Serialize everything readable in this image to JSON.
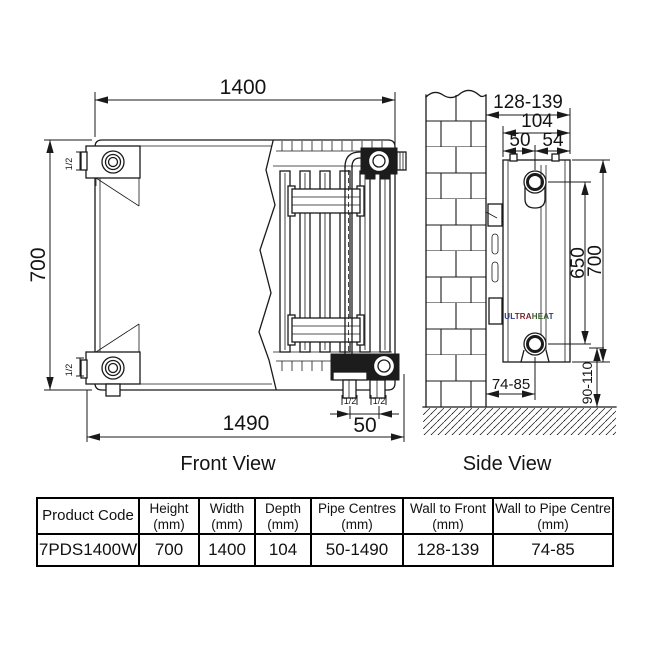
{
  "front_view": {
    "caption": "Front View",
    "dim_width": "1400",
    "dim_height": "700",
    "dim_overall_width": "1490",
    "dim_pipe_spacing": "50",
    "conn_top_left": "1/2",
    "conn_bottom_left": "1/2",
    "conn_bottom_right_1": "1/2",
    "conn_bottom_right_2": "1/2"
  },
  "side_view": {
    "caption": "Side View",
    "dim_wall_to_front": "128-139",
    "dim_depth": "104",
    "dim_back_to_pipe": "50",
    "dim_pipe_to_front": "54",
    "dim_pipe_centres_height": "650",
    "dim_height": "700",
    "dim_floor_clearance": "90-110",
    "dim_wall_to_pipe_centre": "74-85",
    "brand_parts": [
      {
        "text": "UL",
        "color": "#2b3a8a"
      },
      {
        "text": "TRA",
        "color": "#76222c"
      },
      {
        "text": "HEA",
        "color": "#3a5c2f"
      },
      {
        "text": "T",
        "color": "#2b3a8a"
      }
    ]
  },
  "table": {
    "headers": [
      {
        "line1": "Product Code",
        "line2": ""
      },
      {
        "line1": "Height",
        "line2": "(mm)"
      },
      {
        "line1": "Width",
        "line2": "(mm)"
      },
      {
        "line1": "Depth",
        "line2": "(mm)"
      },
      {
        "line1": "Pipe Centres",
        "line2": "(mm)"
      },
      {
        "line1": "Wall to Front",
        "line2": "(mm)"
      },
      {
        "line1": "Wall to Pipe Centre",
        "line2": "(mm)"
      }
    ],
    "row": {
      "product_code": "7PDS1400W",
      "height": "700",
      "width": "1400",
      "depth": "104",
      "pipe_centres": "50-1490",
      "wall_to_front": "128-139",
      "wall_to_pipe_centre": "74-85"
    }
  },
  "colors": {
    "line": "#1a1a1a",
    "dark_fill": "#1c1c1c"
  }
}
